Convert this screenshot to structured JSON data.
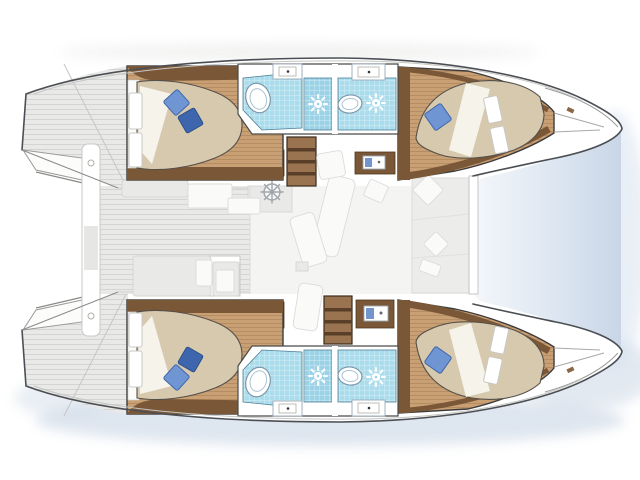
{
  "scene": {
    "type": "catamaran-interior-floor-plan",
    "orientation": "bow-right",
    "hulls": 2,
    "cabins": [
      {
        "id": "aft-port",
        "position": "top-left",
        "bed": "island-double",
        "pillows": 2
      },
      {
        "id": "forward-port",
        "position": "top-right",
        "bed": "bow-double",
        "pillows": 1
      },
      {
        "id": "aft-starboard",
        "position": "bottom-left",
        "bed": "island-double",
        "pillows": 2
      },
      {
        "id": "forward-starboard",
        "position": "bottom-right",
        "bed": "bow-double",
        "pillows": 1
      }
    ],
    "bathrooms": [
      {
        "id": "port-aft-head",
        "fixtures": [
          "toilet",
          "sink",
          "shower"
        ]
      },
      {
        "id": "port-forward-head",
        "fixtures": [
          "toilet",
          "sink",
          "shower"
        ]
      },
      {
        "id": "starboard-aft-head",
        "fixtures": [
          "toilet",
          "sink",
          "shower"
        ]
      },
      {
        "id": "starboard-forward-head",
        "fixtures": [
          "toilet",
          "sink",
          "shower"
        ]
      }
    ],
    "shared": {
      "stairways": 2,
      "helm_wheel_icons": 1,
      "cockpit": "aft-left",
      "trampoline": "bow-right",
      "ghost_furniture": "upper-deck overlay"
    }
  },
  "colors": {
    "background": "#ffffff",
    "hull-fill": "#ffffff",
    "hull-outline": "#4b4f54",
    "deck-base": "#e9e9e8",
    "deck-stripe": "#d4d4d2",
    "salon-floor": "#f4f4f2",
    "wood-floor": "#c99f74",
    "wood-trim": "#7a5737",
    "stair-tread": "#9a7450",
    "stair-riser": "#5a3f28",
    "bed-mattress": "#d7c9ae",
    "bed-sheet": "#f6f3ea",
    "pillow-light": "#6f95d2",
    "pillow-dark": "#3e66ad",
    "tile": "#abdcec",
    "tile-shower": "#9cd2e6",
    "tile-grid": "#e3f4f9",
    "porcelain": "#ffffff",
    "porcelain-stroke": "#7d98ab",
    "ghost": "#e9e9e7",
    "ghost-stroke": "#d6d6d3",
    "ghost-white": "#fafaf9",
    "water-shadow": "#b7c8dc",
    "gap-light": "#f4f7fb",
    "gap-dark": "#c9d6e7",
    "accent-blue": "#5b82c6"
  }
}
